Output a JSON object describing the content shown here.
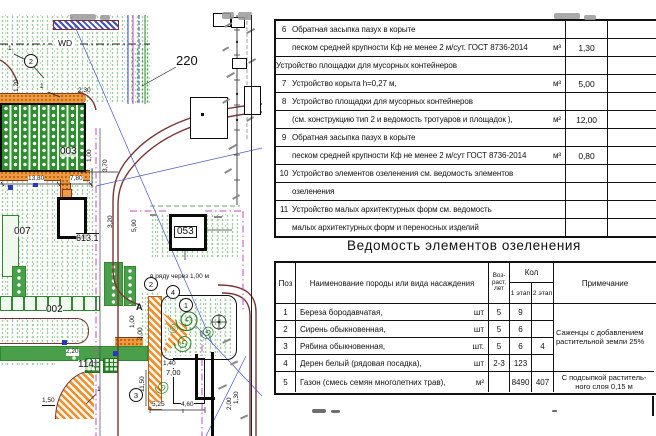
{
  "plan": {
    "labels": {
      "area": "220",
      "wd": "WD",
      "b003": "003",
      "b007": "007",
      "b002": "002",
      "b053": "053",
      "b114": "114",
      "b613": "613.1",
      "a": "A",
      "row_note": "в ряду через 1,00 м"
    },
    "markers": {
      "m1": "1",
      "m2a": "2",
      "m2b": "2",
      "m3": "3",
      "m4": "4"
    },
    "dims": {
      "d120": "1,20",
      "d230": "2,30",
      "d1380": "13,80",
      "d780": "7,80",
      "d100a": "1,00",
      "d370": "3,70",
      "d320": "3,20",
      "d590": "5,90",
      "d220": "2,20",
      "d150": "1,50",
      "n1a": "1",
      "n1b": "1",
      "n1c": "1",
      "d1150": "11,50",
      "d100b": "1,00",
      "d300": "3,00",
      "d140": "1,40",
      "d700": "7,00",
      "d525": "5,25",
      "d460": "4,60",
      "d130": "1,30",
      "d200": "2,00"
    }
  },
  "works_table": {
    "rows": [
      {
        "num": "6",
        "text": "Обратная засыпка пазух в корыте",
        "unit": "",
        "qty": ""
      },
      {
        "num": "",
        "text": "песком средней крупности  Кф не менее 2 м/сут. ГОСТ 8736-2014",
        "unit": "м³",
        "qty": "1,30"
      },
      {
        "num": "",
        "text": "Устройство площадки для мусорных контейнеров",
        "unit": "",
        "qty": "",
        "center": true
      },
      {
        "num": "7",
        "text": "Устройство корыта h=0,27 м,",
        "unit": "м³",
        "qty": "5,00"
      },
      {
        "num": "8",
        "text": "Устройство площадки для мусорных контейнеров",
        "unit": "",
        "qty": ""
      },
      {
        "num": "",
        "text": "(см. конструкцию тип 2 и ведомость тротуаров и площадок ),",
        "unit": "м²",
        "qty": "12,00"
      },
      {
        "num": "9",
        "text": "Обратная засыпка пазух в корыте",
        "unit": "",
        "qty": ""
      },
      {
        "num": "",
        "text": "песком средней крупности  Кф не менее 2 м/сут ГОСТ 8736-2014",
        "unit": "м³",
        "qty": "0,80"
      },
      {
        "num": "10",
        "text": "Устройство элементов озеленения см. ведомость элементов",
        "unit": "",
        "qty": ""
      },
      {
        "num": "",
        "text": "озеленения",
        "unit": "",
        "qty": ""
      },
      {
        "num": "11",
        "text": "Устройство малых архитектурных форм см. ведомость",
        "unit": "",
        "qty": ""
      },
      {
        "num": "",
        "text": "малых архитектурных форм и переносных изделий",
        "unit": "",
        "qty": ""
      }
    ]
  },
  "greenery": {
    "title": "Ведомость элементов озеленения",
    "headers": {
      "pos": "Поз",
      "name": "Наименование породы или вида насаждения",
      "age_l1": "Воз-",
      "age_l2": "раст,",
      "age_l3": "лет",
      "qty": "Кол",
      "stage1": "1 этап",
      "stage2": "2 этап",
      "note": "Примечание"
    },
    "rows": [
      {
        "pos": "1",
        "name": "Береза бородавчатая,",
        "unit": "шт",
        "age": "5",
        "s1": "9",
        "s2": ""
      },
      {
        "pos": "2",
        "name": "Сирень обыкновенная,",
        "unit": "шт",
        "age": "5",
        "s1": "6",
        "s2": ""
      },
      {
        "pos": "3",
        "name": "Рябина обыкновенная,",
        "unit": "шт.",
        "age": "5",
        "s1": "6",
        "s2": "4"
      },
      {
        "pos": "4",
        "name": "Дерен белый (рядовая посадка),",
        "unit": "шт",
        "age": "2-3",
        "s1": "123",
        "s2": ""
      },
      {
        "pos": "5",
        "name": "Газон (смесь семян многолетних трав),",
        "unit": "м²",
        "age": "",
        "s1": "8490",
        "s2": "407"
      }
    ],
    "note_rows_1_4_l1": "Саженцы с добавлением",
    "note_rows_1_4_l2": "растительной земли 25%",
    "note_row_5_l1": "С подсыпкой раститель-",
    "note_row_5_l2": "ного слоя 0,15 м"
  }
}
